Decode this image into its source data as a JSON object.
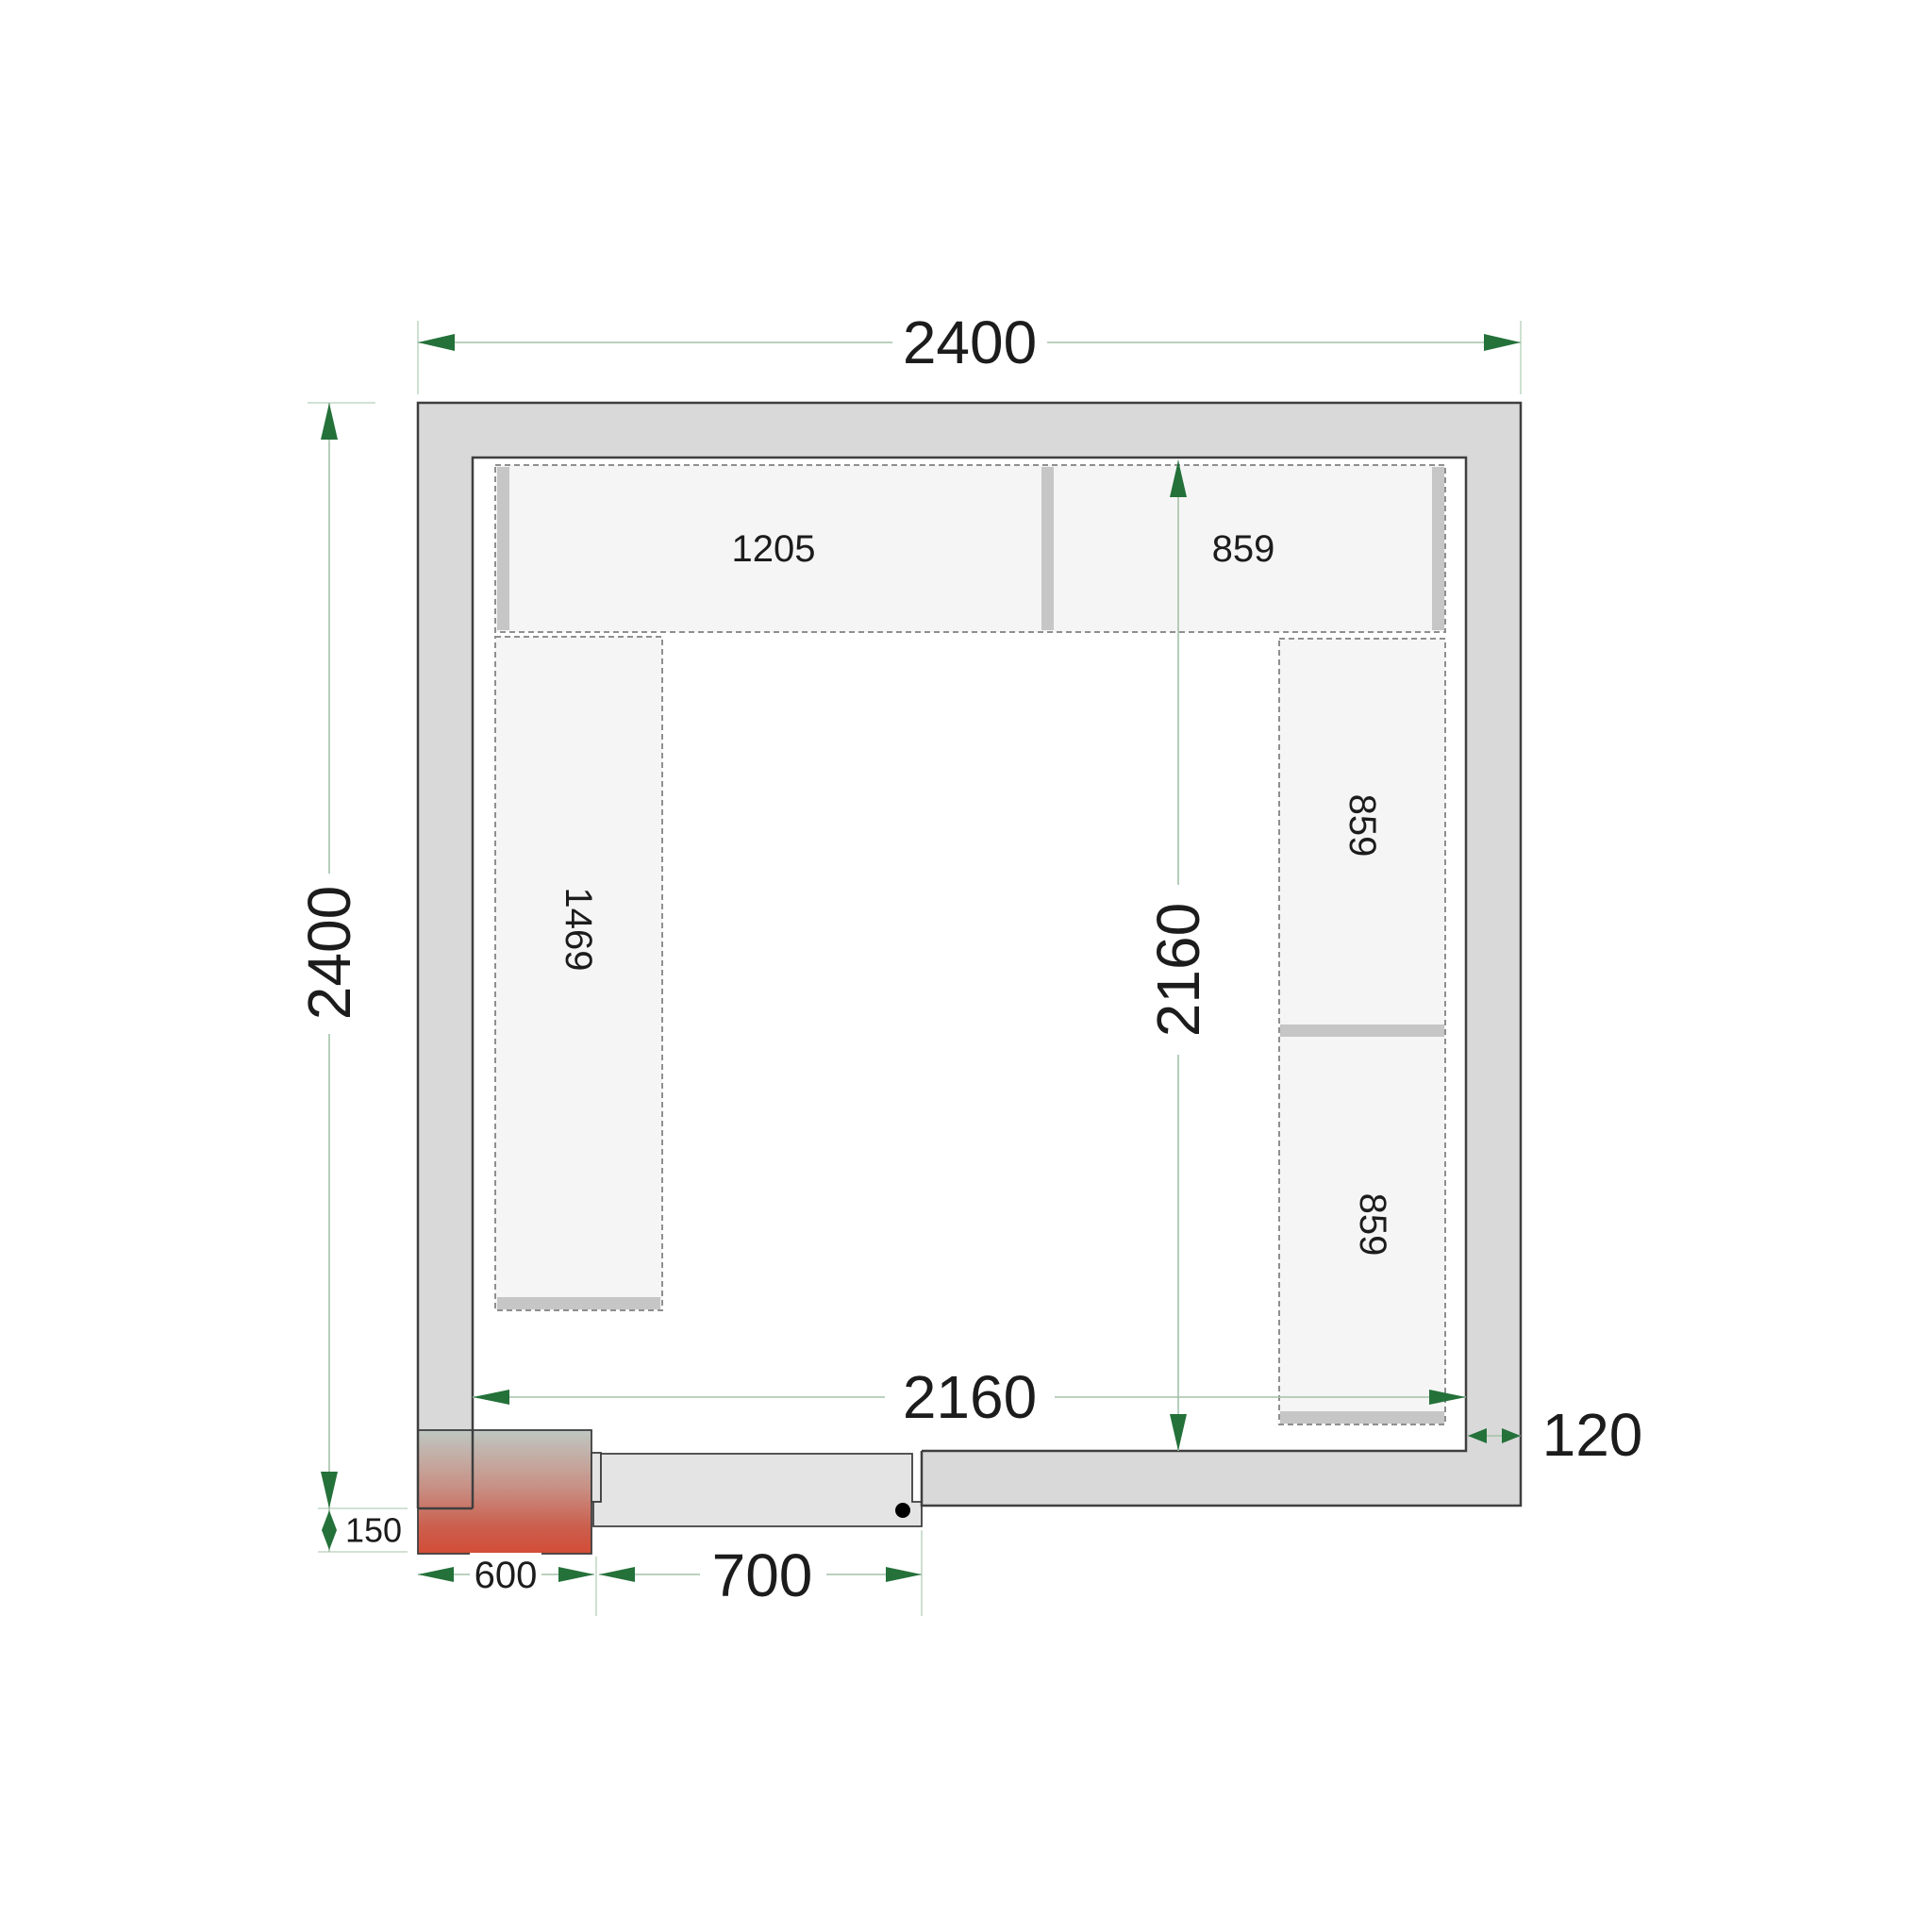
{
  "drawing": {
    "title": "cold-room-floor-plan",
    "dimensions": {
      "outer_width": "2400",
      "outer_height": "2400",
      "inner_width": "2160",
      "inner_height": "2160",
      "wall_thickness": "120",
      "unit_width": "600",
      "unit_offset": "150",
      "door_width": "700"
    },
    "shelves": {
      "top_left": "1205",
      "top_right": "859",
      "left": "1469",
      "right_upper": "859",
      "right_lower": "859"
    },
    "colors": {
      "wall_fill": "#d9d9d9",
      "wall_outline": "#3f3f3f",
      "shelf_fill": "#f5f5f5",
      "shelf_border": "#8f8f8f",
      "shelf_end_bar": "#c6c6c6",
      "dim_line": "#a3c2a8",
      "ext_line": "#c2d8c5",
      "arrow_green": "#24713a",
      "label_text": "#1c1c1c",
      "door_fill": "#e4e4e4",
      "unit_gradient_top": "#bec7c1",
      "unit_gradient_mid": "#c89287",
      "unit_gradient_low": "#cb5f4e",
      "unit_gradient_bottom": "#d34c36"
    }
  }
}
